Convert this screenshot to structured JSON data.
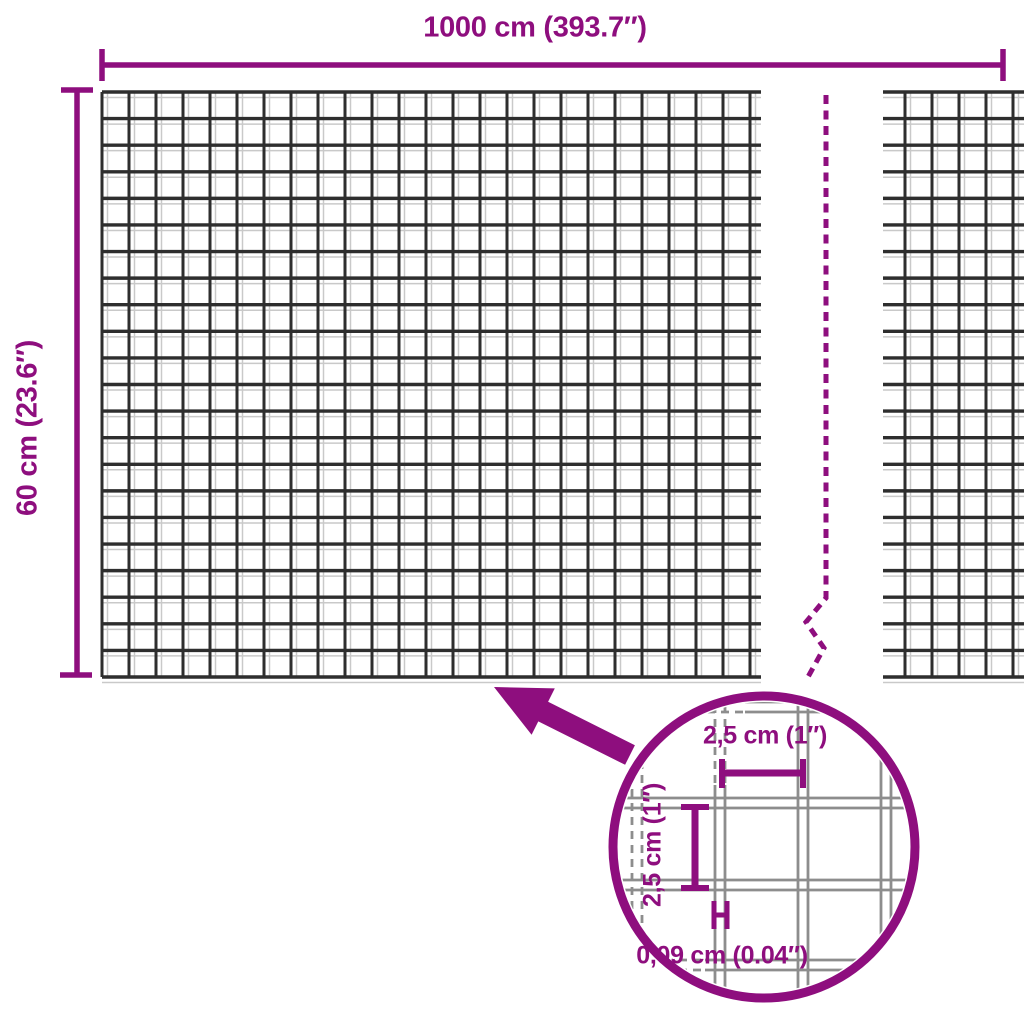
{
  "diagram": {
    "type": "product-dimension-diagram",
    "subject": "wire-mesh-roll"
  },
  "labels": {
    "width": "1000 cm (393.7″)",
    "height": "60 cm (23.6″)",
    "mesh_cell_width": "2,5 cm (1″)",
    "mesh_cell_height": "2,5 cm (1″)",
    "wire_thickness": "0,09 cm (0.04″)"
  },
  "colors": {
    "accent": "#8E0E7E",
    "mesh_wire_dark": "#2e2e2e",
    "mesh_wire_light": "#c9c9c9",
    "inset_wire_gray": "#8d8d8d"
  }
}
